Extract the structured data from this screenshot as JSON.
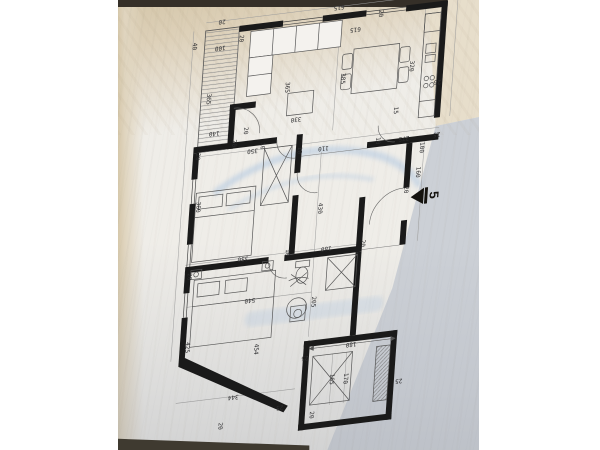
{
  "photo": {
    "surface_top_color": "#d5c7ab",
    "paper_color": "#efede8",
    "shadow_panel_color": "#c9cdd4",
    "table_edge_color": "#3f3a30"
  },
  "plan": {
    "type": "apartment-floor-plan",
    "wall_color": "#1a1a1a",
    "line_color": "#6a6a6a",
    "watermark_color": "#86aede",
    "entrance_marker": {
      "label": "5"
    },
    "dims": [
      {
        "t": "20",
        "x": 40,
        "y": 8,
        "r": 180
      },
      {
        "t": "615",
        "x": 158,
        "y": 8,
        "r": 180
      },
      {
        "t": "20",
        "x": 258,
        "y": 8,
        "r": 180
      },
      {
        "t": "40",
        "x": 13,
        "y": 30,
        "r": 90
      },
      {
        "t": "100",
        "x": 40,
        "y": 34,
        "r": 180
      },
      {
        "t": "20",
        "x": 60,
        "y": 28,
        "r": 90
      },
      {
        "t": "365",
        "x": 31,
        "y": 84,
        "r": 90
      },
      {
        "t": "140",
        "x": 40,
        "y": 118,
        "r": 180
      },
      {
        "t": "20",
        "x": 60,
        "y": 131,
        "r": 90
      },
      {
        "t": "365",
        "x": 110,
        "y": 82,
        "r": 90
      },
      {
        "t": "330",
        "x": 122,
        "y": 114,
        "r": 180
      },
      {
        "t": "20",
        "x": 71,
        "y": 120,
        "r": 90
      },
      {
        "t": "10",
        "x": 89,
        "y": 137,
        "r": 90
      },
      {
        "t": "615",
        "x": 176,
        "y": 32,
        "r": 180
      },
      {
        "t": "20",
        "x": 200,
        "y": 20,
        "r": 90
      },
      {
        "t": "385",
        "x": 166,
        "y": 80,
        "r": 90
      },
      {
        "t": "320",
        "x": 235,
        "y": 76,
        "r": 90
      },
      {
        "t": "25",
        "x": 263,
        "y": 94,
        "r": 180
      },
      {
        "t": "15",
        "x": 222,
        "y": 118,
        "r": 90
      },
      {
        "t": "275",
        "x": 233,
        "y": 146,
        "r": 180
      },
      {
        "t": "25",
        "x": 266,
        "y": 146,
        "r": 180
      },
      {
        "t": "100",
        "x": 251,
        "y": 158,
        "r": 90
      },
      {
        "t": "10",
        "x": 206,
        "y": 146,
        "r": 90
      },
      {
        "t": "110",
        "x": 152,
        "y": 146,
        "r": 180
      },
      {
        "t": "10",
        "x": 127,
        "y": 146,
        "r": 90
      },
      {
        "t": "350",
        "x": 80,
        "y": 140,
        "r": 180
      },
      {
        "t": "20",
        "x": 24,
        "y": 140,
        "r": 90
      },
      {
        "t": "160",
        "x": 249,
        "y": 182,
        "r": 90
      },
      {
        "t": "20",
        "x": 238,
        "y": 198,
        "r": 90
      },
      {
        "t": "430",
        "x": 152,
        "y": 206,
        "r": 90
      },
      {
        "t": "360",
        "x": 28,
        "y": 190,
        "r": 90
      },
      {
        "t": "350",
        "x": 78,
        "y": 246,
        "r": 180
      },
      {
        "t": "10",
        "x": 122,
        "y": 246,
        "r": 90
      },
      {
        "t": "180",
        "x": 162,
        "y": 246,
        "r": 180
      },
      {
        "t": "20",
        "x": 198,
        "y": 246,
        "r": 90
      },
      {
        "t": "20",
        "x": 24,
        "y": 258,
        "r": 90
      },
      {
        "t": "540",
        "x": 88,
        "y": 288,
        "r": 180
      },
      {
        "t": "205",
        "x": 152,
        "y": 298,
        "r": 90
      },
      {
        "t": "425",
        "x": 27,
        "y": 328,
        "r": 90
      },
      {
        "t": "454",
        "x": 97,
        "y": 338,
        "r": 90
      },
      {
        "t": "25",
        "x": 148,
        "y": 352,
        "r": 180
      },
      {
        "t": "344",
        "x": 78,
        "y": 382,
        "r": 180
      },
      {
        "t": "20",
        "x": 66,
        "y": 410,
        "r": 90
      },
      {
        "t": "25",
        "x": 126,
        "y": 398,
        "r": 180
      },
      {
        "t": "180",
        "x": 194,
        "y": 344,
        "r": 180
      },
      {
        "t": "165",
        "x": 176,
        "y": 377,
        "r": 90
      },
      {
        "t": "170",
        "x": 190,
        "y": 378,
        "r": 90
      },
      {
        "t": "20",
        "x": 158,
        "y": 410,
        "r": 90
      },
      {
        "t": "25",
        "x": 245,
        "y": 386,
        "r": 180
      }
    ]
  }
}
